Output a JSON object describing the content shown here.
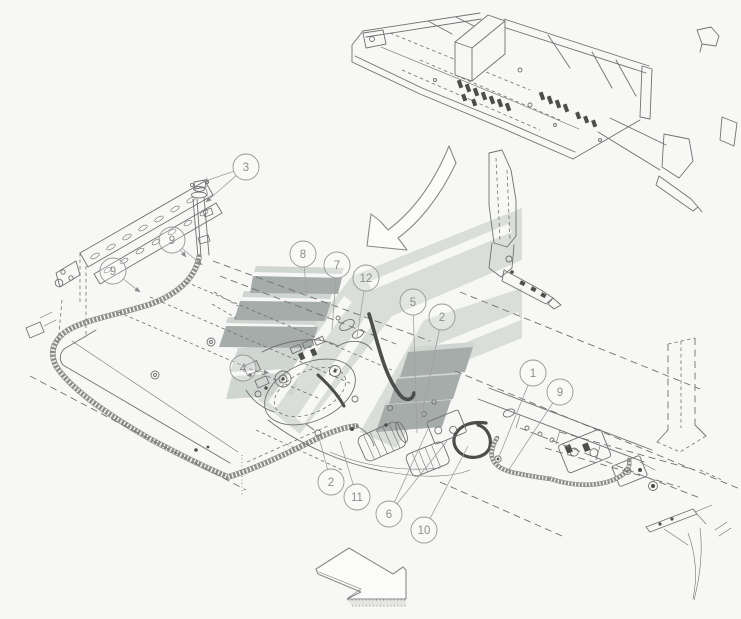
{
  "diagram": {
    "kind": "hydraulic-hose-parts-exploded-diagram",
    "background": "#f7f7f5",
    "line_color": "#717171",
    "dark_line_color": "#4d4d4b",
    "watermark": {
      "stripe_dark": "#a6aca9",
      "stripe_light": "#cfd5d0",
      "band": "#d9ded8"
    },
    "callout_style": {
      "radius": 13,
      "stroke": "#979797",
      "text_color": "#8d8d8d",
      "leader_color": "#a0a0a0"
    },
    "callouts": [
      {
        "label": "3",
        "cx": 246,
        "cy": 167,
        "leaders": [
          [
            203,
            182
          ],
          [
            206,
            202
          ]
        ],
        "arrow": true
      },
      {
        "label": "9",
        "cx": 172,
        "cy": 240,
        "leaders": [
          [
            186,
            257
          ],
          [
            202,
            265
          ]
        ],
        "arrow": true
      },
      {
        "label": "9",
        "cx": 113,
        "cy": 271,
        "leaders": [
          [
            140,
            292
          ]
        ],
        "arrow": true
      },
      {
        "label": "8",
        "cx": 303,
        "cy": 254,
        "leaders": [
          [
            307,
            296
          ]
        ],
        "arrow": false
      },
      {
        "label": "7",
        "cx": 337,
        "cy": 265,
        "leaders": [
          [
            332,
            330
          ]
        ],
        "arrow": false
      },
      {
        "label": "12",
        "cx": 366,
        "cy": 278,
        "leaders": [
          [
            357,
            337
          ]
        ],
        "arrow": false
      },
      {
        "label": "5",
        "cx": 413,
        "cy": 302,
        "leaders": [
          [
            417,
            433
          ]
        ],
        "arrow": false
      },
      {
        "label": "2",
        "cx": 442,
        "cy": 317,
        "leaders": [
          [
            421,
            419
          ]
        ],
        "arrow": false
      },
      {
        "label": "4",
        "cx": 243,
        "cy": 368,
        "leaders": [
          [
            269,
            373
          ]
        ],
        "arrow": true
      },
      {
        "label": "1",
        "cx": 533,
        "cy": 373,
        "leaders": [
          [
            498,
            459
          ]
        ],
        "arrow": false
      },
      {
        "label": "9",
        "cx": 560,
        "cy": 392,
        "leaders": [
          [
            508,
            471
          ]
        ],
        "arrow": false
      },
      {
        "label": "2",
        "cx": 331,
        "cy": 482,
        "leaders": [
          [
            318,
            434
          ]
        ],
        "arrow": false
      },
      {
        "label": "11",
        "cx": 357,
        "cy": 497,
        "leaders": [
          [
            340,
            441
          ]
        ],
        "arrow": false
      },
      {
        "label": "6",
        "cx": 389,
        "cy": 514,
        "leaders": [
          [
            428,
            429
          ],
          [
            447,
            441
          ]
        ],
        "arrow": false
      },
      {
        "label": "10",
        "cx": 424,
        "cy": 530,
        "leaders": [
          [
            468,
            446
          ]
        ],
        "arrow": false
      }
    ]
  }
}
